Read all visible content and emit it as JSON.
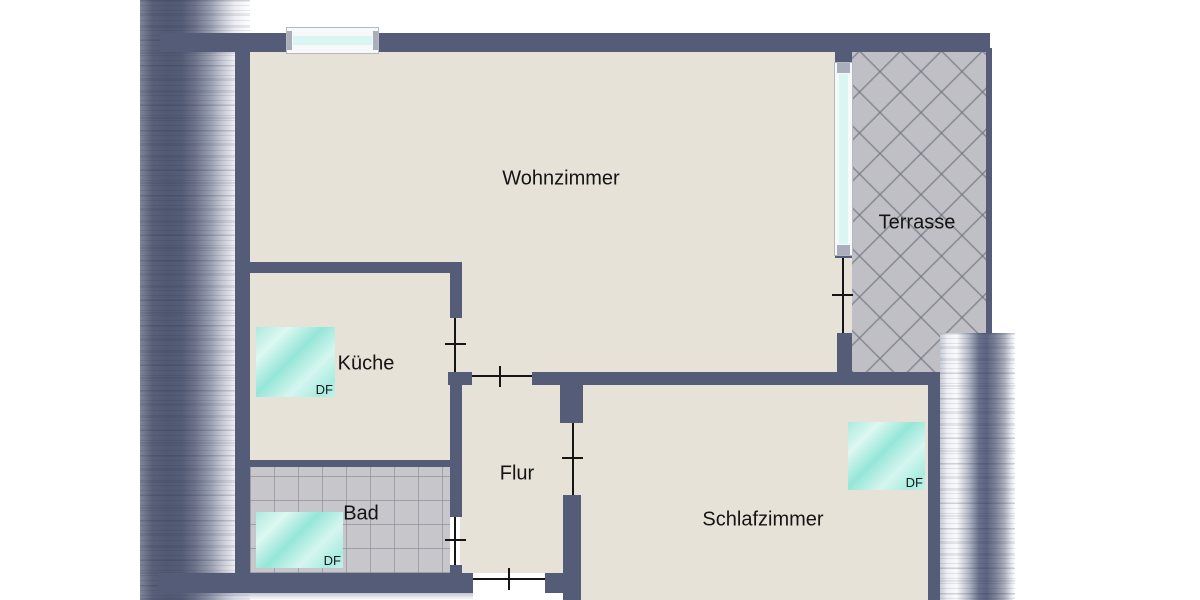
{
  "floorplan": {
    "rooms": {
      "wohnzimmer": "Wohnzimmer",
      "kueche": "Küche",
      "bad": "Bad",
      "flur": "Flur",
      "schlafzimmer": "Schlafzimmer",
      "terrasse": "Terrasse"
    },
    "skylight_label": "DF",
    "colors": {
      "wall": "#555c78",
      "floor": "#e7e2d8",
      "bad_tiles": "#c6c6cb",
      "terrace_tiles": "#bfbfc5",
      "skylight": "#a9ece0",
      "window_glass": "#d9f6f3",
      "door_line": "#151515",
      "text": "#141414"
    }
  }
}
